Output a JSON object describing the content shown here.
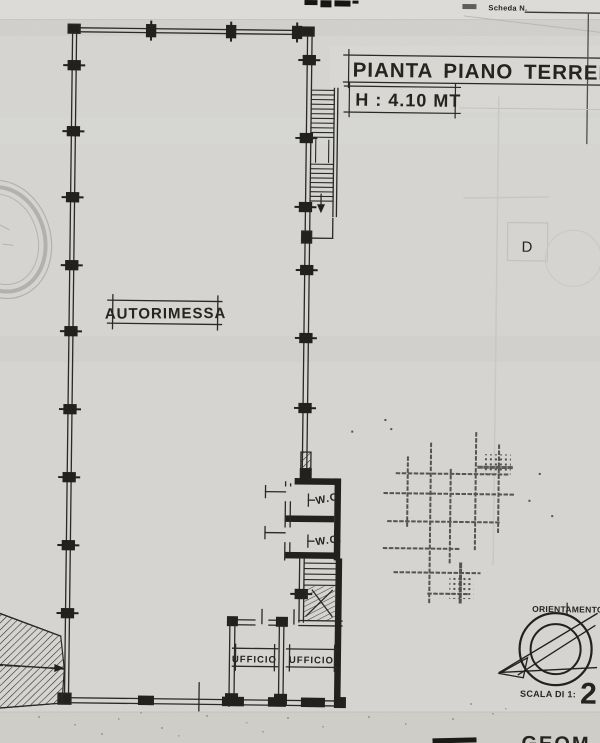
{
  "sheet": {
    "scheda_label": "Scheda N.",
    "title": "PIANTA PIANO TERRENO",
    "height_note": "H : 4.10 MT"
  },
  "rooms": {
    "garage": "AUTORIMESSA",
    "wc_top": "W.C.",
    "wc_bottom": "W.C.",
    "office_left": "UFFICIO",
    "office_right": "UFFICIO"
  },
  "footer": {
    "orientation_label": "ORIENTAMENTO",
    "scale_label": "SCALA DI 1:",
    "scale_value": "2",
    "signature_fragment": "GEOM",
    "ghost_letter": "D"
  },
  "colors": {
    "paper": "#d7d6d2",
    "ink": "#26241f",
    "faint": "#b9b8b4"
  }
}
